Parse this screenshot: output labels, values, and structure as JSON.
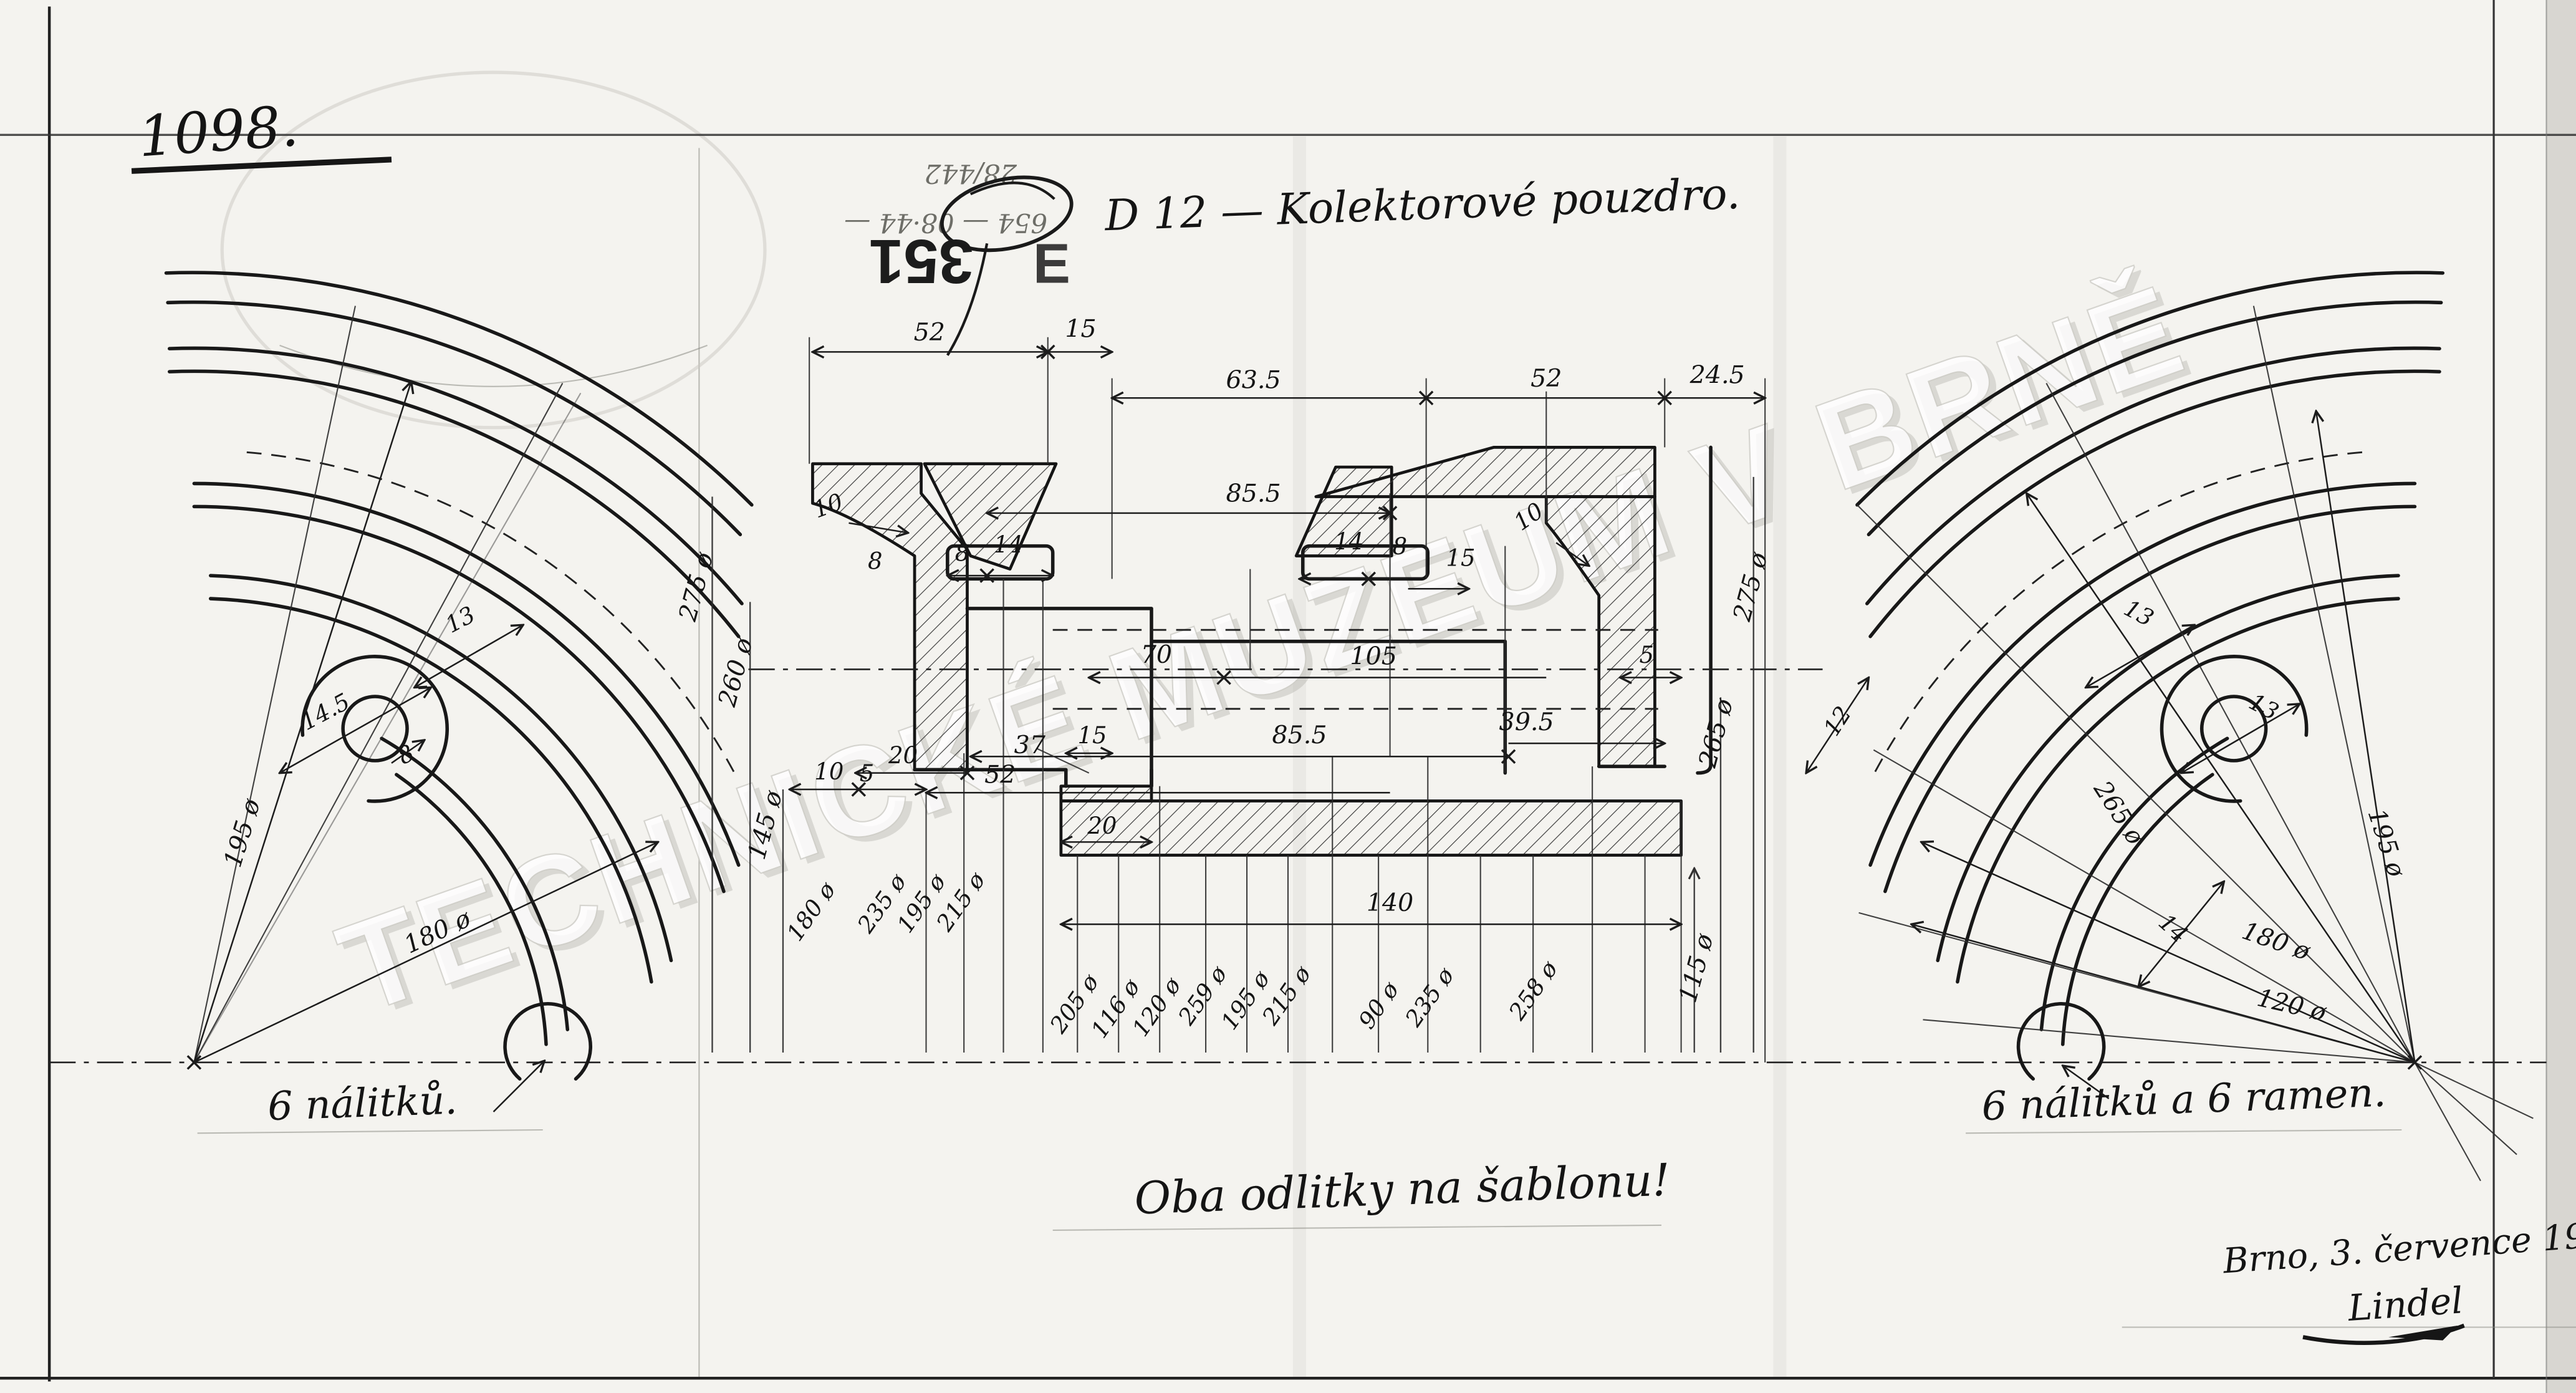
{
  "sheet": {
    "drawing_number": "1098.",
    "stamp_number": "351",
    "stamp_letter": "E",
    "title": "D 12 — Kolektorové pouzdro.",
    "watermark": "TECHNICKÉ MUZEUM V BRNĚ",
    "pencil_notes": {
      "line1": "28/442",
      "line2": "654 — 08·44 —"
    },
    "notes": {
      "left_wheel": "6 nálitků.",
      "right_wheel": "6 nálitků a 6 ramen.",
      "both": "Oba odlitky na šablonu!"
    },
    "footer": {
      "place_date": "Brno, 3. července 1909.",
      "signature": "Lindel"
    },
    "colors": {
      "paper": "#f4f3ef",
      "ink": "#1c1c1c",
      "pencil": "#6e6e68",
      "watermark": "#ffffff",
      "page_edge": "#d8d6d1"
    }
  },
  "section": {
    "top_dims": {
      "d52a": "52",
      "d15": "15",
      "d63_5": "63.5",
      "d52b": "52",
      "d24_5": "24.5"
    },
    "inner_dims": {
      "d85_5_top": "85.5",
      "d10_left": "10",
      "d10_right": "10",
      "d8_left_outer": "8",
      "d8_left": "8",
      "d14_left": "14",
      "d14_right": "14",
      "d8_right": "8",
      "d15_right": "15",
      "d70": "70",
      "d105": "105",
      "d5_right": "5",
      "d85_5_bottom": "85.5",
      "d39_5": "39.5",
      "d15_bottom": "15",
      "d37": "37",
      "d52_bottom": "52",
      "d20_left": "20",
      "d10_bottom": "10",
      "d5_bottom": "5",
      "d20_notch": "20",
      "d140": "140"
    },
    "diameters": {
      "d275_left": "275 ø",
      "d260": "260 ø",
      "d145": "145 ø",
      "d180_left": "180 ø",
      "d235_left": "235 ø",
      "d195_left": "195 ø",
      "d215_left": "215 ø",
      "d205": "205 ø",
      "d116": "116 ø",
      "d120": "120 ø",
      "d259": "259 ø",
      "d195_mid": "195 ø",
      "d215_mid": "215 ø",
      "d90": "90 ø",
      "d235_mid": "235 ø",
      "d258": "258 ø",
      "d115": "115 ø",
      "d265_right": "265 ø",
      "d275_right": "275 ø"
    }
  },
  "left_wheel": {
    "d195": "195 ø",
    "d180": "180 ø",
    "d14_5": "14.5",
    "d13": "13",
    "d8": "8"
  },
  "right_wheel": {
    "d13_rim": "13",
    "d13_boss": "13",
    "d265": "265 ø",
    "d195": "195 ø",
    "d180": "180 ø",
    "d120": "120 ø",
    "d14": "14",
    "d12": "12"
  }
}
